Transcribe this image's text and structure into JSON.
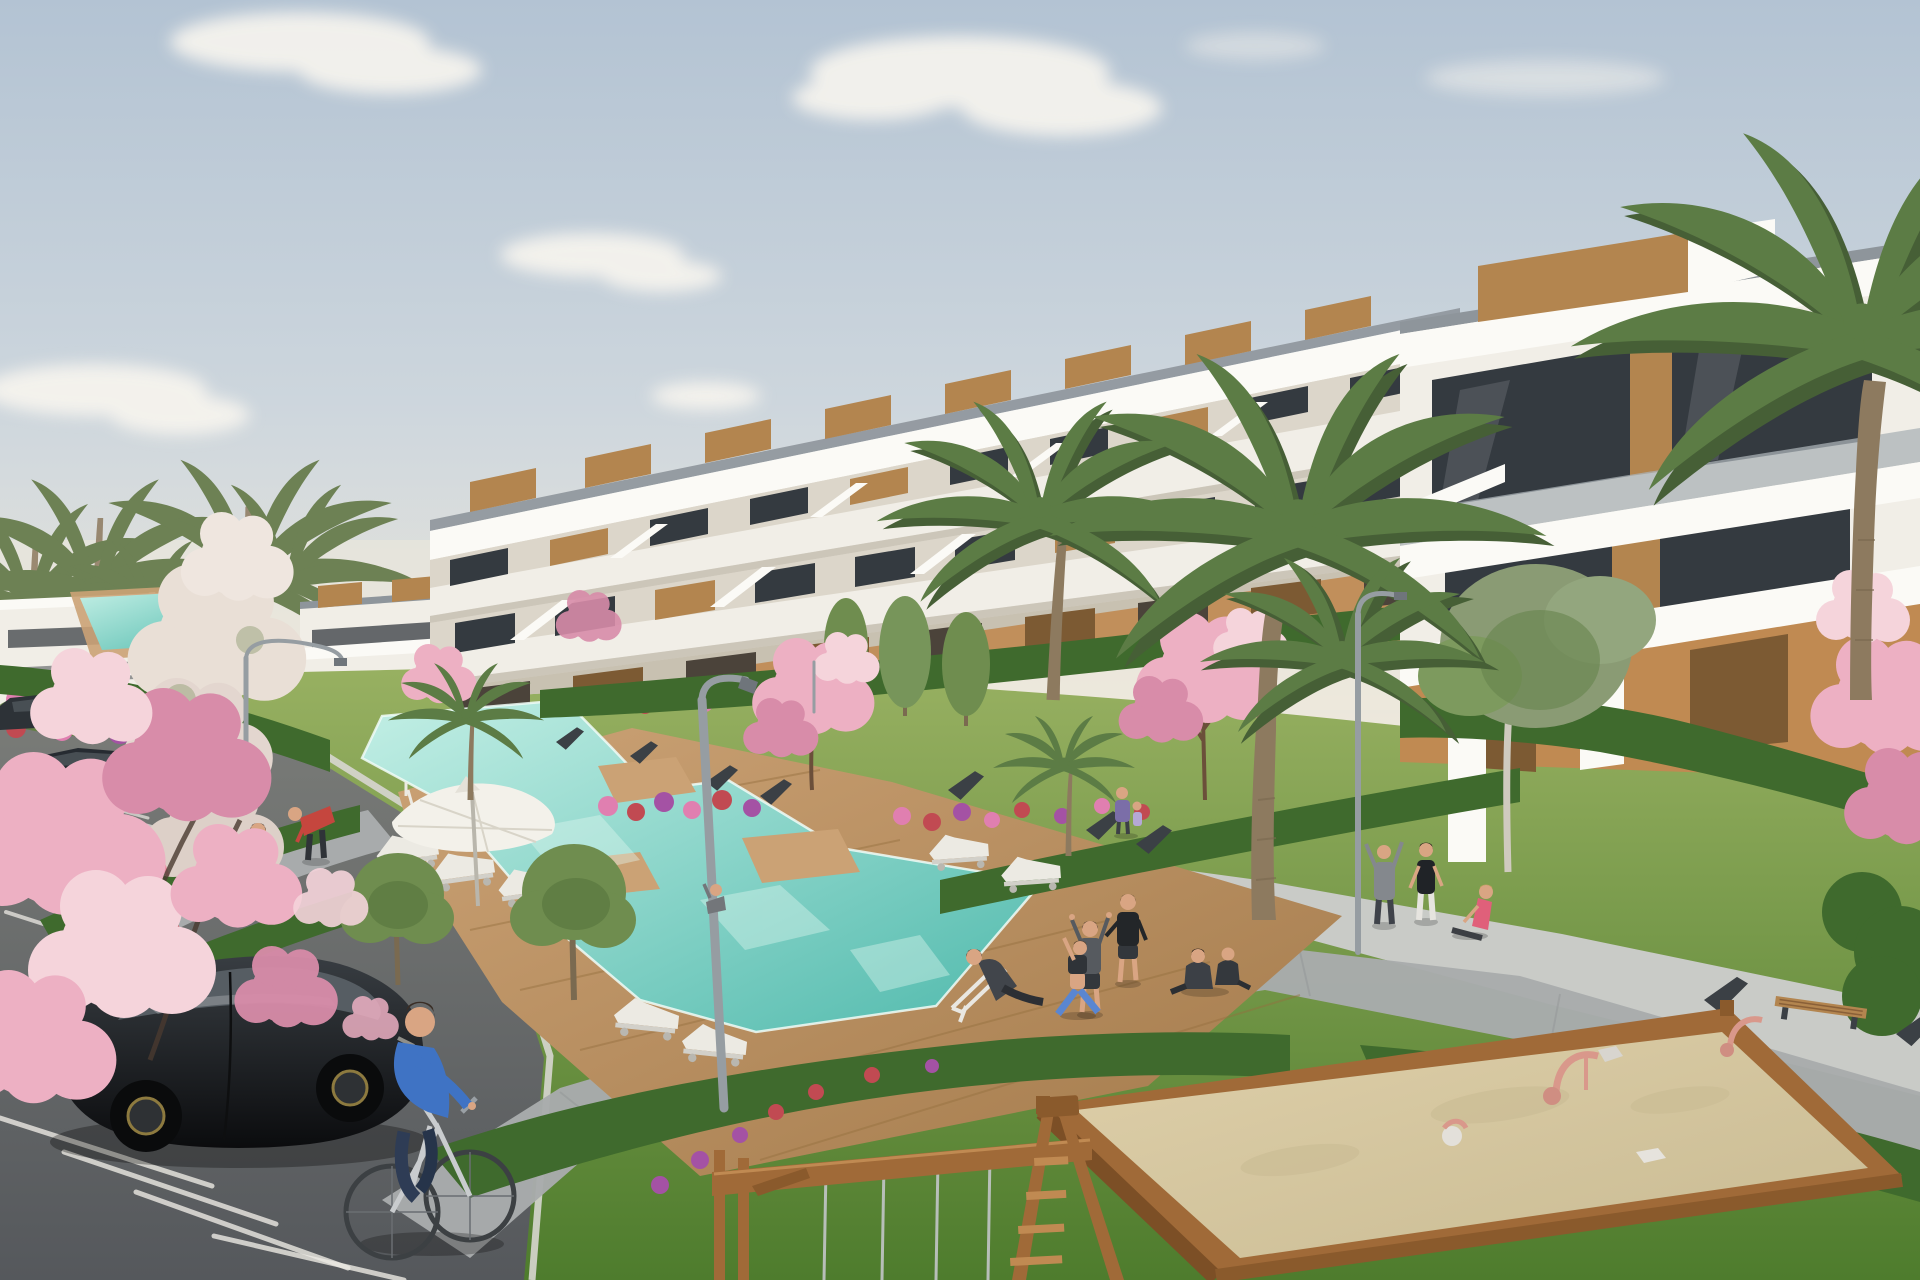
{
  "meta": {
    "title": "New-build residential complex — exterior 3D visualization",
    "kind": "architectural-render",
    "canvas": {
      "width": 1920,
      "height": 1280
    }
  },
  "scene": {
    "description": "Elevated 3D render of a modern white apartment complex with stepped terraces, wooden rooftop pergolas and glass balustrades. Communal gardens hold palm trees, pink blossom trees, hedges and flower beds, two turquoise pools with wooden decks, white sun loungers and a parasol. A parking area with cars and a cyclist sits lower-left; a sandbox playground with a wooden swing frame sits lower-right; residents walk, stretch and lounge throughout under a pale hazy sky.",
    "palette": {
      "sky_top": "#b3c3d3",
      "sky_mid": "#cdd6dd",
      "sky_low": "#ede8dc",
      "cloud": "#f7f4ee",
      "haze": "#efe9dc",
      "grass_far": "#9ab263",
      "grass_near": "#4e7c2d",
      "asphalt_far": "#7b7d79",
      "asphalt_near": "#55585c",
      "curb": "#d7d6d0",
      "line": "#eceae4",
      "bldg_white": "#f1eee7",
      "bldg_bright": "#fbfaf6",
      "bldg_shade": "#dcd6ca",
      "bldg_recess": "#c8c1b1",
      "rail": "#8e959b",
      "glass": "#343a40",
      "wood": "#b3854f",
      "wood_dark": "#7c5a33",
      "ochre": "#c08a52",
      "pool_light": "#c3efe5",
      "pool_deep": "#4fb9ac",
      "pool_edge": "#f0fbf7",
      "deck_light": "#cba275",
      "deck_dark": "#a37a4b",
      "path": "#a8abac",
      "plaza": "#c9cbc7",
      "hedge": "#3f6a2d",
      "hedge_dark": "#2f5321",
      "flower_pink": "#e07fb0",
      "flower_red": "#c14a52",
      "flower_purple": "#a452a4",
      "blossom": "#edb0c3",
      "blossom_deep": "#d88ca9",
      "blossom_pale": "#f5d4db",
      "white_bloom": "#e9dfd6",
      "tree": "#6f8d4f",
      "tree_pale": "#8a9b74",
      "palm": "#5c7c45",
      "palm_shadow": "#465f36",
      "palm_far": "#6d8154",
      "trunk": "#8d7a5f",
      "sand": "#decfa9",
      "sand_shade": "#c9bb93",
      "swing_wood": "#a06a38",
      "swing_dark": "#7c4f26",
      "swing_light": "#c08a52",
      "lamp": "#969da2",
      "bench": "#3b4045",
      "lounger": "#eceae3",
      "umbrella": "#f3f1ea",
      "car_paint": "#141619",
      "car_glass": "#596066",
      "sedan": "#262b31",
      "skin": "#d9a583",
      "blue_shirt": "#3f73c4",
      "jeans": "#2e3c55",
      "teal_top": "#4fb0a5",
      "pink_top": "#e890a2",
      "red_top": "#c5463e",
      "grey_cloth": "#73767a",
      "dark_cloth": "#2f3237",
      "white_cloth": "#e6e4df",
      "purple_top": "#7b6ea8",
      "leggings": "#5a86d1",
      "ball": "#e8e6e0"
    },
    "elements": {
      "sky": {
        "clouds": 6
      },
      "buildings": {
        "terraced_row_floors": 3,
        "rooftop_pergolas": 10,
        "near_building_right": true,
        "distant_building_left": true
      },
      "landscape": {
        "pools": 2,
        "wood_decks": true,
        "sun_loungers": 7,
        "parasols": 1,
        "palm_trees": 12,
        "blossom_trees": 6,
        "street_lamps": 3,
        "hedges": true,
        "flower_beds": true
      },
      "recreation": {
        "sandbox": true,
        "sand_toys": 3,
        "swing_frame": true,
        "benches": 8
      },
      "vehicles": {
        "parked_cars": 3,
        "bicycles": 1
      },
      "people": {
        "count": 17,
        "activities": [
          "walking",
          "cycling",
          "stretching",
          "yoga",
          "sitting",
          "lounging",
          "playing ball"
        ]
      }
    }
  }
}
